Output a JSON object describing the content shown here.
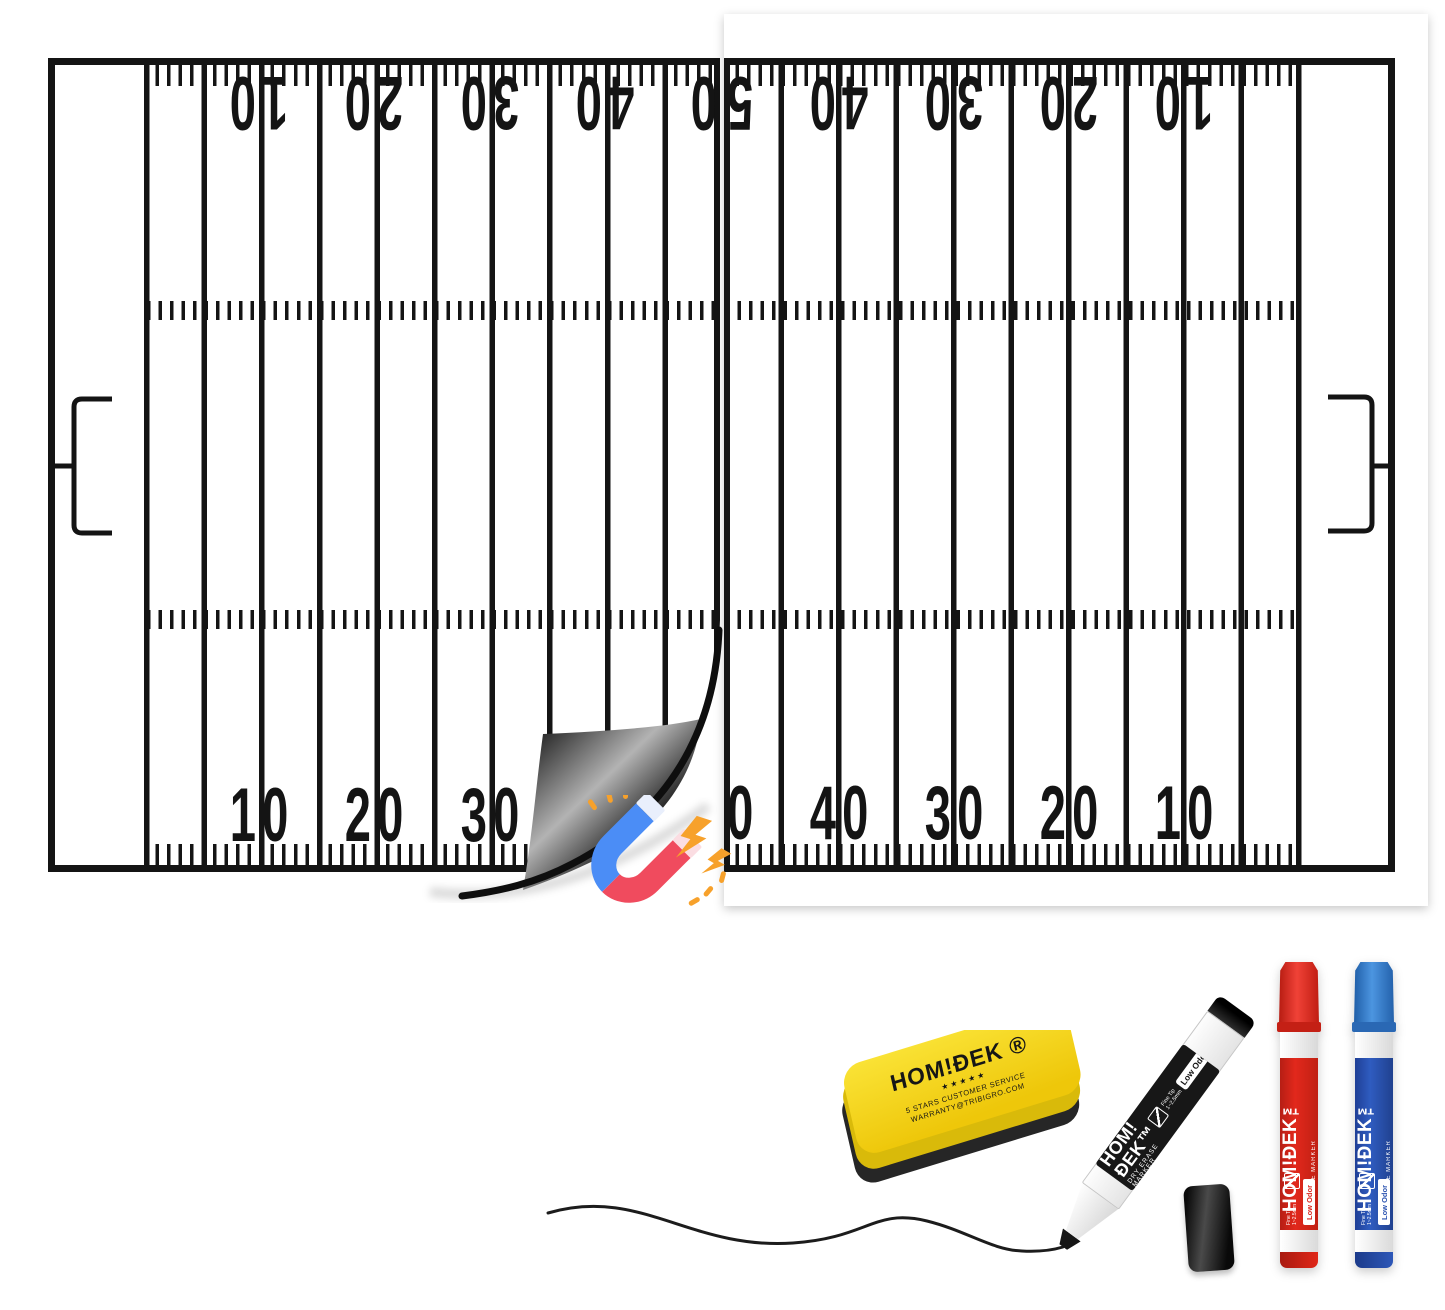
{
  "brand": {
    "name": "HOMIDEK",
    "logo": "HOM!ÐEK",
    "logo_tm": "HOM!ÐEK™",
    "logo_reg": "HOM!ÐEK ®"
  },
  "field": {
    "numbers_up": [
      "10",
      "20",
      "30",
      "40"
    ],
    "midfield": "50",
    "numbers_down": [
      "40",
      "30",
      "20",
      "10"
    ]
  },
  "eraser": {
    "stars": "★ ★ ★ ★ ★",
    "service_line": "5 STARS CUSTOMER SERVICE",
    "warranty_line": "WARRANTY@TRIBIGRO.COM"
  },
  "marker": {
    "type": "DRY ERASE MARKER",
    "badge": "Low Odor",
    "tip_spec": "Fine Tip 1~2.5mm"
  },
  "icons": {
    "magnet": "magnet-with-sparks-emoji",
    "tip_icon": "marker-tip-pictogram"
  },
  "colors": {
    "ink": "#141414",
    "board_white": "#ffffff",
    "magnet_blue": "#4b8df6",
    "magnet_red": "#f04b5e",
    "spark_orange": "#f7a12b",
    "eraser_yellow": "#f5d216",
    "marker_red": "#d8251b",
    "marker_blue": "#2a52b0",
    "marker_black": "#111111"
  }
}
